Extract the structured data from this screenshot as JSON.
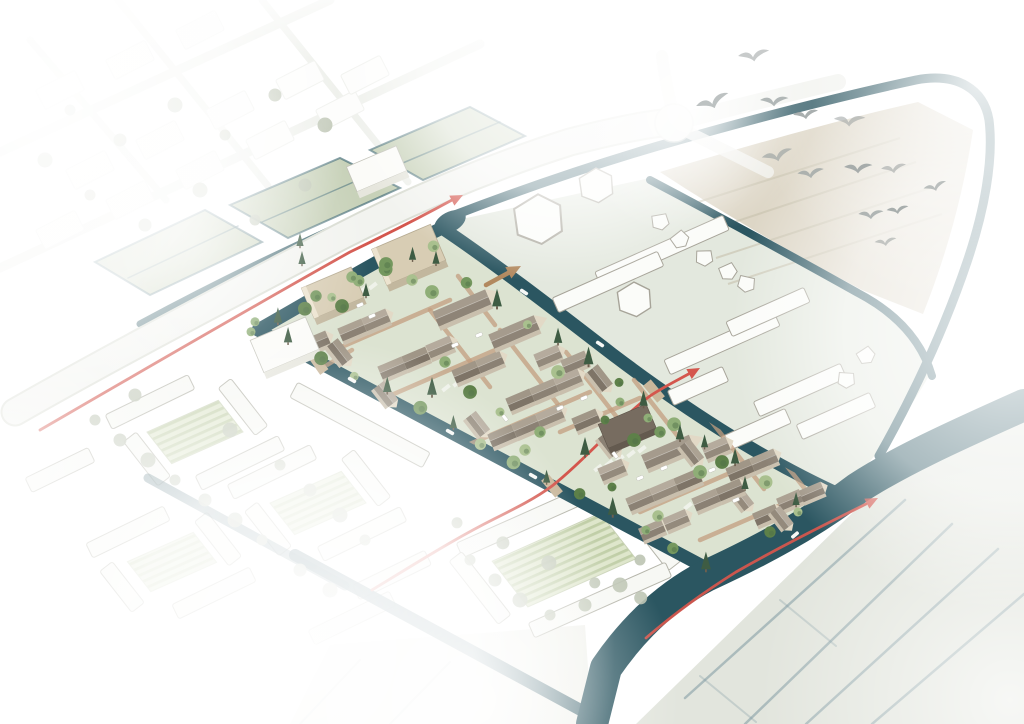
{
  "canvas": {
    "width": 1024,
    "height": 724
  },
  "illustration": {
    "type": "axonometric-masterplan-birdseye",
    "features": {
      "birds_count": 13,
      "boats_count": 6,
      "bridges_count": 3,
      "houses_count": 39,
      "barn_buildings_count": 3,
      "apartment_blocks_count": 2,
      "community_building_count": 1,
      "context_box_buildings_count": 2,
      "red_route_arrows": 3,
      "tan_arrows": 1,
      "trees_approx": 100
    },
    "colors": {
      "paper": "#ffffff",
      "canal": "#2b5661",
      "canalDeep": "#234e59",
      "road": "#f2f3ef",
      "roadEdge": "#d9dcd2",
      "redRoute": "#d4564d",
      "tanArrow": "#b2895f",
      "siteGround": "#dce3d1",
      "fieldGreen": "#c7d1b8",
      "ditchTeal": "#476f79",
      "plate": "#e3e8de",
      "plateBuilding": "#fbfcf9",
      "plateStroke": "#a7a499",
      "tanField": "#d9d2c0",
      "tanHatch": "#c6bfab",
      "contextFill": "#f7f8f4",
      "contextStroke": "#b5b5aa",
      "allotment": "#dee6cb",
      "allotmentStripe": "#c0cea7",
      "seField": "#e2e5dd",
      "seDitch": "#7e99a1",
      "paleField": "#edefe8",
      "wall": "#e2d9c6",
      "wallShade": "#c9bfad",
      "boxTop": "#d8cdb4",
      "boxSideL": "#ece3cf",
      "boxSideD": "#c2b79e",
      "whiteBoxTop": "#fbfbf8",
      "whiteBoxSide": "#e6e6dd",
      "commRoof": "#776c60",
      "commSide": "#645a4f",
      "pine": "#3e5c43",
      "contextTree": "#bdc4b2",
      "treeDark": "#4e6f47",
      "bird": "#9aa1a1",
      "boat": "#f7f8f6",
      "car": "#ffffff",
      "bridge": "#c9b79b",
      "streetBrick": "#c39e7f"
    },
    "tree_palette": [
      "#8fae77",
      "#74975e",
      "#5d8049",
      "#a9c08e"
    ],
    "roof_variants": [
      {
        "light": "#aca293",
        "dark": "#8b8174"
      },
      {
        "light": "#b5ab9d",
        "dark": "#948a7c"
      },
      {
        "light": "#a09687",
        "dark": "#7e7467"
      },
      {
        "light": "#a59b8d",
        "dark": "#8e8477"
      }
    ]
  }
}
